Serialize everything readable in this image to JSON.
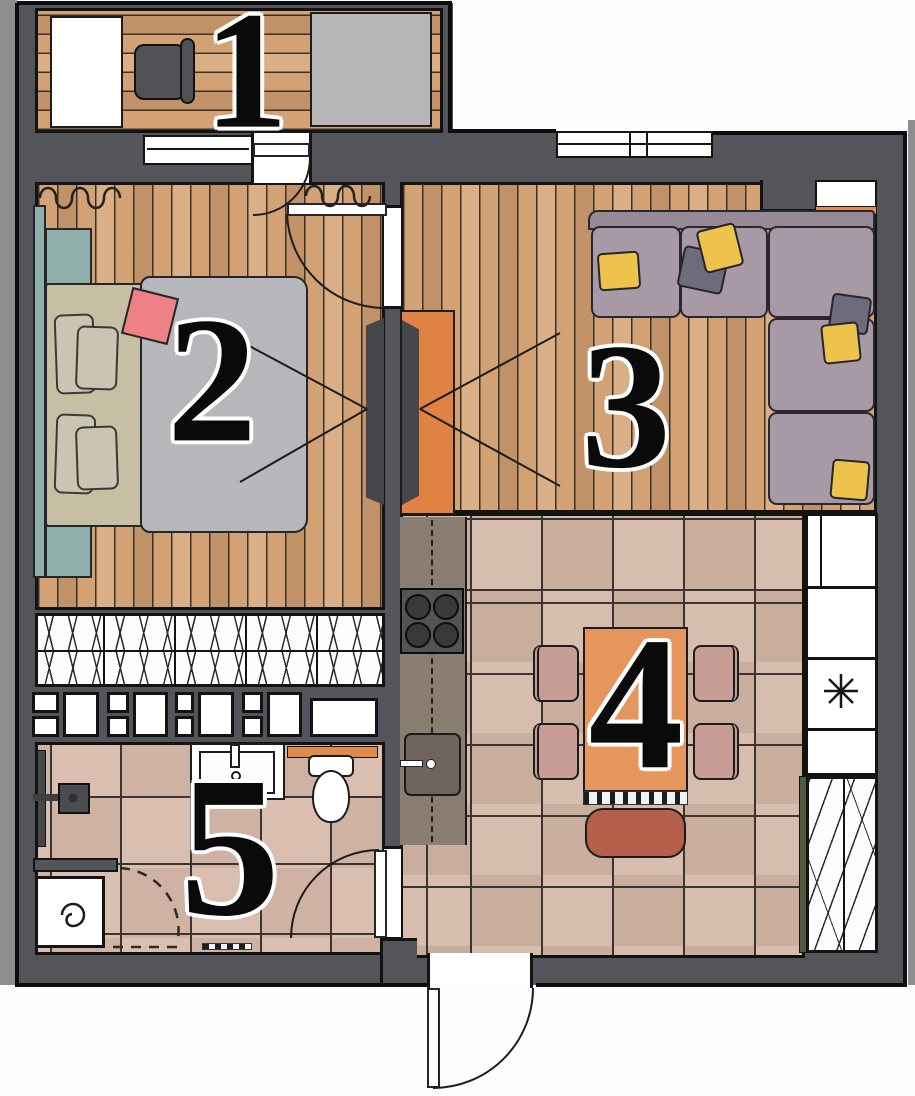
{
  "rooms": [
    {
      "number": "1",
      "name": "balcony"
    },
    {
      "number": "2",
      "name": "bedroom"
    },
    {
      "number": "3",
      "name": "living-room"
    },
    {
      "number": "4",
      "name": "kitchen-dining"
    },
    {
      "number": "5",
      "name": "bathroom"
    }
  ],
  "symbols": {
    "appliance_marker": "*"
  },
  "palette": {
    "wall": "#54555a",
    "outline": "#131313",
    "wood_floor": "#d2a275",
    "tile_kitchen": "#d7bdae",
    "tile_bath": "#dabfb1",
    "accent_orange": "#e1904f",
    "sofa_mauve": "#a79aa6",
    "pillow_yellow": "#eec34d",
    "bed_duvet": "#b5b7ba",
    "wardrobe_teal": "#8fafa9",
    "accent_pink": "#ed8186",
    "chair_rose": "#c89d96",
    "bench_rust": "#b4604a",
    "outside": "#8e8e90"
  }
}
